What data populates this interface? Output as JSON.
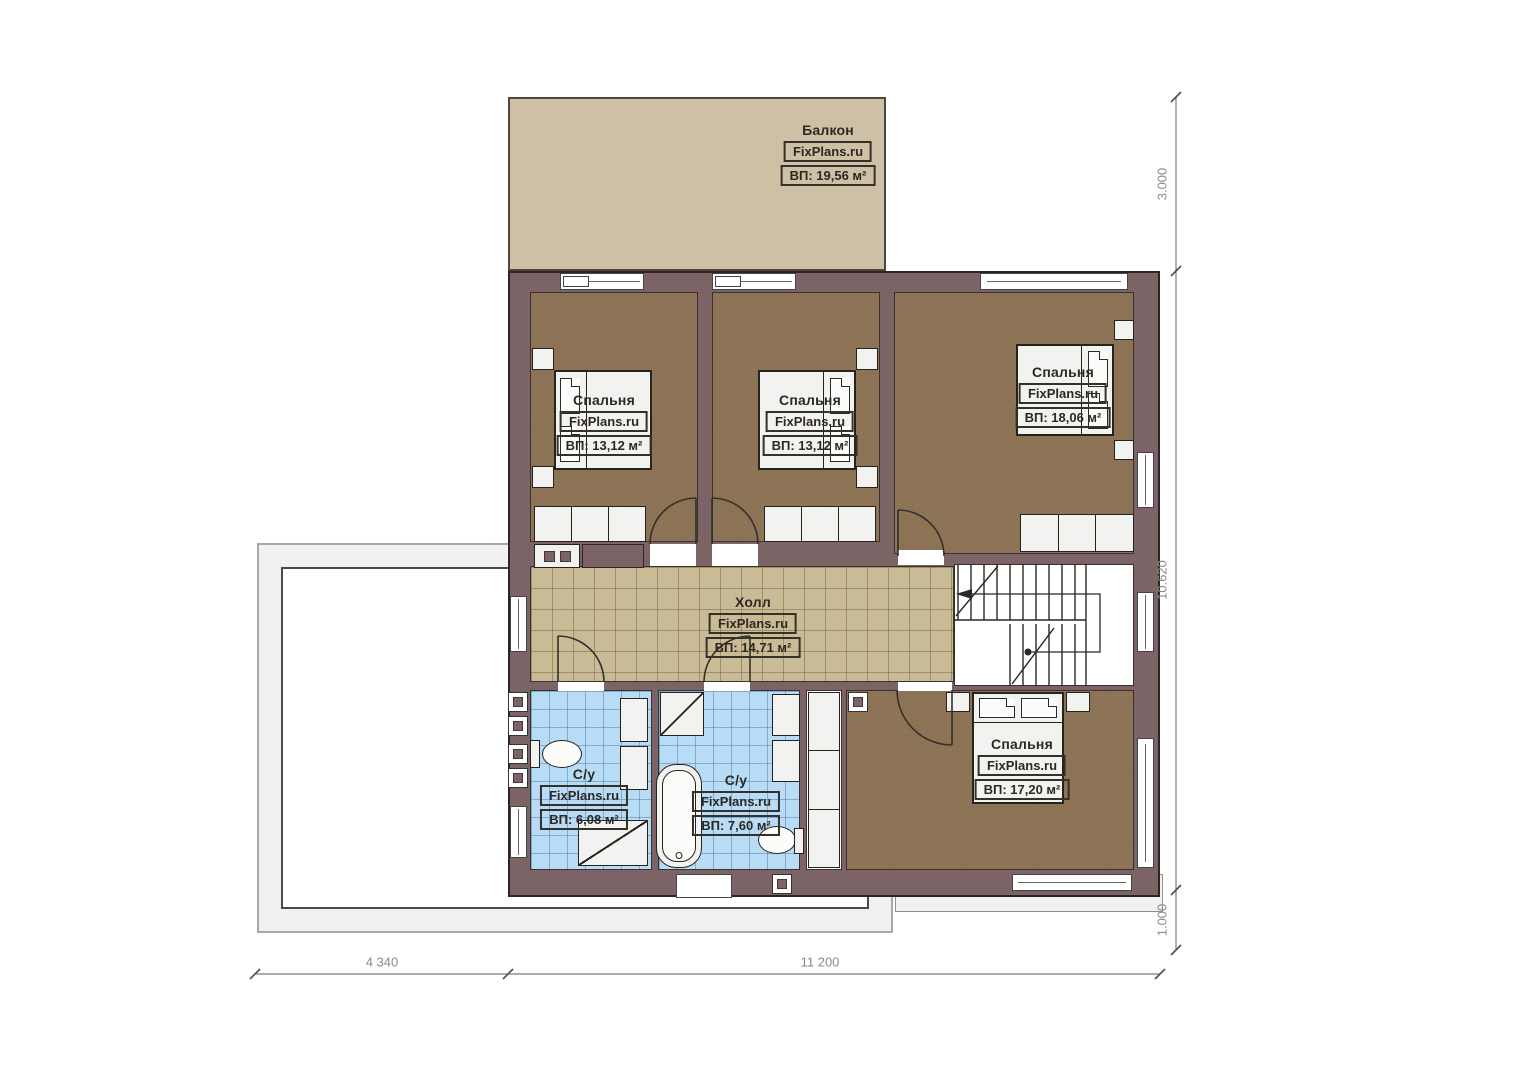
{
  "brand": "FixPlans.ru",
  "rooms": [
    {
      "id": "balcony",
      "name": "Балкон",
      "brand": "FixPlans.ru",
      "area": "ВП: 19,56 м²"
    },
    {
      "id": "bedroom-1",
      "name": "Спальня",
      "brand": "FixPlans.ru",
      "area": "ВП: 13,12 м²"
    },
    {
      "id": "bedroom-2",
      "name": "Спальня",
      "brand": "FixPlans.ru",
      "area": "ВП: 13,12 м²"
    },
    {
      "id": "bedroom-3",
      "name": "Спальня",
      "brand": "FixPlans.ru",
      "area": "ВП: 18,06 м²"
    },
    {
      "id": "hall",
      "name": "Холл",
      "brand": "FixPlans.ru",
      "area": "ВП: 14,71 м²"
    },
    {
      "id": "bathroom-1",
      "name": "С/у",
      "brand": "FixPlans.ru",
      "area": "ВП: 6,08 м²"
    },
    {
      "id": "bathroom-2",
      "name": "С/у",
      "brand": "FixPlans.ru",
      "area": "ВП: 7,60 м²"
    },
    {
      "id": "bedroom-4",
      "name": "Спальня",
      "brand": "FixPlans.ru",
      "area": "ВП: 17,20 м²"
    }
  ],
  "dimensions": {
    "right_top": "3.000",
    "right_middle": "10.620",
    "right_bottom": "1.000",
    "bottom_left": "4 340",
    "bottom_right": "11 200"
  },
  "colors": {
    "wall": "#7b6366",
    "wall_outline": "#2c2526",
    "bedroom_floor": "#8c7355",
    "hall_floor": "#cabb97",
    "bathroom_floor": "#b9dcf6",
    "balcony_floor": "#cec0a4",
    "furniture": "#f2f2f0",
    "dimension_text": "#8a8a8a"
  }
}
